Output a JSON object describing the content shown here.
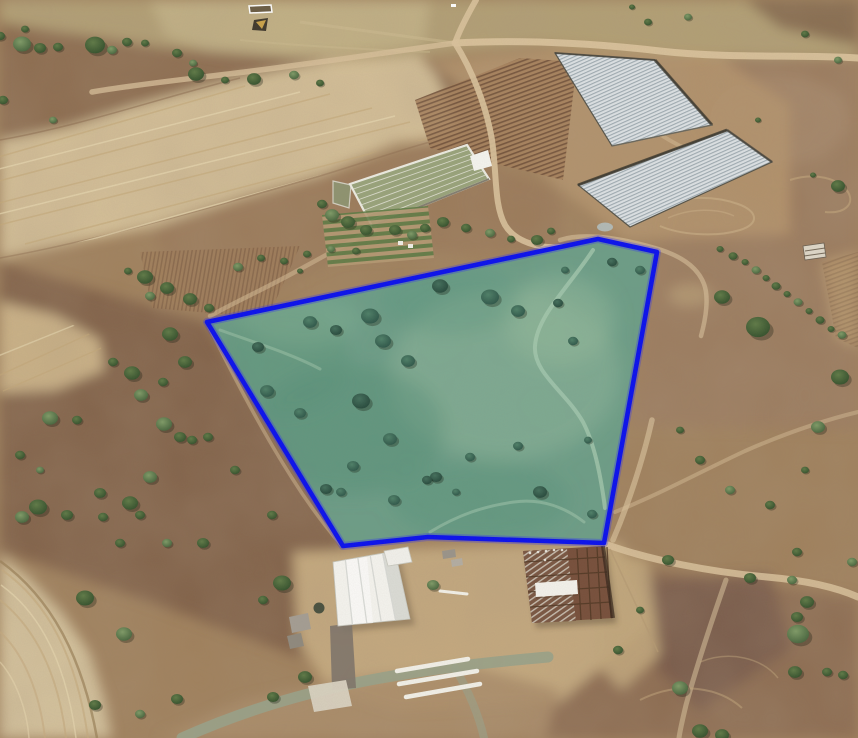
{
  "scene": {
    "kind": "aerial-satellite-imagery",
    "subject": "rural farmland with highlighted land parcel boundary"
  },
  "parcel": {
    "points": "207,322 598,239 657,252 604,543 428,537 343,546",
    "outline_color": "#0a10ee",
    "outline_width": 4.6,
    "glow_color": "#2a2aff",
    "fill_color": "#68a08b",
    "fill_opacity": 0.92
  },
  "palette": {
    "terrain_base": "#a0805c",
    "top_field": "#b3a074",
    "plowed_band": "#d7c29a",
    "scrub_dark": "#82624a",
    "right_brown": "#9c7c5f",
    "farm_yard": "#c6aa7f",
    "pale_field": "#d7c59f",
    "road": "#d9c29c",
    "gray_road": "#99a28a",
    "greenhouse_light": "#dde2e5",
    "greenhouse_stripe": "#9fabb2",
    "warehouse_white": "#f5f4ef",
    "steel_rust": "#774f3b",
    "tree_dark": "#304d2a",
    "tree_teal": "#2a5246",
    "parcel_track": "#a6cab0"
  },
  "features": {
    "greenhouses": {
      "upper_points": "555,53 655,60 712,125 612,146",
      "lower_points": "578,185 727,130 772,162 630,227",
      "nursery_points": "350,184 467,145 489,179 372,226",
      "nursery_cap_points": "470,156 488,150 492,166 474,171",
      "nursery_annex_points": "333,181 351,185 349,208 333,203",
      "garden_points": "322,215 428,206 434,258 328,267",
      "rows_field_points": "415,100 520,58 577,62 563,180 430,148",
      "rows_left_points": "140,252 300,246 268,318 152,308",
      "tr_rows_points": "822,262 858,252 858,348 836,338"
    },
    "farm": {
      "warehouse_points": "333,562 395,551 410,619 338,626",
      "warehouse_annex_points": "384,551 408,547 412,562 388,566",
      "steel_frame_points": "523,551 603,546 613,618 532,623",
      "steel_hatch_points": "523,551 567,549 576,621 532,623",
      "beam_points": "535,583 577,580 578,594 536,597",
      "driveway_points": "330,626 352,623 356,688 332,690",
      "pad_points": "308,686 346,680 352,706 314,712",
      "shed_ne_points": "803,246 824,243 826,257 805,260",
      "corral_points": "249,6 271,5 272,12 250,13",
      "mound_points": "254,20 268,18 266,31 252,30"
    },
    "pond": {
      "cx": 605,
      "cy": 227,
      "rx": 8,
      "ry": 4.5
    },
    "roads": [
      {
        "name": "top-east",
        "d": "M 455,43 C 530,39 600,44 660,51 C 730,59 800,54 858,58",
        "w": 7,
        "op": 0.95
      },
      {
        "name": "top-west",
        "d": "M 455,43 C 420,48 350,58 290,66 C 220,76 150,82 92,92",
        "w": 5.5,
        "op": 0.75
      },
      {
        "name": "top-stub",
        "d": "M 476,0 C 468,14 460,29 455,43",
        "w": 6,
        "op": 0.9
      },
      {
        "name": "down-to-parcel",
        "d": "M 455,43 C 472,70 486,105 492,140 C 497,175 494,205 505,225 C 515,242 540,249 562,247",
        "w": 6,
        "op": 0.9
      },
      {
        "name": "along-parcel-top",
        "d": "M 560,240 C 585,232 620,238 655,248 C 683,256 698,268 704,284 C 709,297 706,318 701,336",
        "w": 4.5,
        "op": 0.6
      },
      {
        "name": "parcel-right-low",
        "d": "M 652,420 C 643,460 628,505 613,540",
        "w": 5.5,
        "op": 0.65
      },
      {
        "name": "farm-east",
        "d": "M 608,545 C 650,560 710,572 767,577 C 812,581 840,589 858,597",
        "w": 7,
        "op": 0.85
      },
      {
        "name": "farm-branch-south",
        "d": "M 726,580 C 712,620 697,665 686,705 C 682,722 680,730 679,738",
        "w": 5,
        "op": 0.55
      },
      {
        "name": "northeast-track",
        "d": "M 615,512 C 660,494 700,472 745,451 C 786,433 825,420 858,412",
        "w": 4,
        "op": 0.45
      },
      {
        "name": "gray-road",
        "d": "M 182,738 C 240,712 300,694 360,682 C 420,670 480,663 548,657",
        "w": 11,
        "color": "#99a28a",
        "op": 0.9
      },
      {
        "name": "gray-branch",
        "d": "M 455,668 C 468,690 478,712 484,738",
        "w": 8,
        "color": "#99a28a",
        "op": 0.6
      },
      {
        "name": "nursery-west",
        "d": "M 375,228 C 348,243 320,258 295,272 C 268,287 235,302 210,316",
        "w": 4.5,
        "op": 0.5
      },
      {
        "name": "below-parcel-west",
        "d": "M 209,327 C 228,365 258,425 292,478 C 312,510 330,532 341,545",
        "w": 3.5,
        "op": 0.45
      },
      {
        "name": "between-greenhouses",
        "d": "M 640,120 C 665,140 690,152 718,162",
        "w": 4,
        "op": 0.45
      }
    ],
    "tracks_in_parcel": [
      {
        "d": "M 593,250 C 568,288 537,316 535,346 C 533,373 566,392 583,422 C 595,445 601,478 605,508",
        "w": 4,
        "op": 0.75
      },
      {
        "d": "M 430,532 C 458,515 484,506 514,502 C 542,498 566,508 584,522",
        "w": 3,
        "op": 0.5
      },
      {
        "d": "M 220,330 C 256,343 292,354 320,369",
        "w": 3,
        "op": 0.45
      }
    ],
    "pipes": [
      [
        397,
        671,
        468,
        659,
        4.5
      ],
      [
        399,
        684,
        477,
        671,
        4.5
      ],
      [
        406,
        697,
        480,
        684,
        4.5
      ],
      [
        440,
        591,
        467,
        594,
        3
      ]
    ],
    "trees_outside": [
      [
        22,
        44,
        9
      ],
      [
        40,
        48,
        6
      ],
      [
        58,
        47,
        5
      ],
      [
        95,
        45,
        10
      ],
      [
        112,
        50,
        5
      ],
      [
        127,
        42,
        5
      ],
      [
        145,
        43,
        4
      ],
      [
        177,
        53,
        5
      ],
      [
        193,
        63,
        4
      ],
      [
        25,
        29,
        4
      ],
      [
        0,
        36,
        5
      ],
      [
        3,
        100,
        5
      ],
      [
        53,
        120,
        4
      ],
      [
        196,
        74,
        8
      ],
      [
        225,
        80,
        4
      ],
      [
        254,
        79,
        7
      ],
      [
        294,
        75,
        5
      ],
      [
        320,
        83,
        4
      ],
      [
        128,
        271,
        4
      ],
      [
        145,
        277,
        8
      ],
      [
        150,
        296,
        5
      ],
      [
        167,
        288,
        7
      ],
      [
        190,
        299,
        7
      ],
      [
        209,
        308,
        5
      ],
      [
        238,
        267,
        5
      ],
      [
        261,
        258,
        4
      ],
      [
        284,
        261,
        4
      ],
      [
        307,
        254,
        4
      ],
      [
        331,
        249,
        4
      ],
      [
        356,
        251,
        4
      ],
      [
        300,
        271,
        3
      ],
      [
        322,
        204,
        5
      ],
      [
        332,
        215,
        7
      ],
      [
        348,
        222,
        7
      ],
      [
        366,
        230,
        6
      ],
      [
        395,
        230,
        6
      ],
      [
        412,
        235,
        5
      ],
      [
        425,
        228,
        5
      ],
      [
        443,
        222,
        6
      ],
      [
        466,
        228,
        5
      ],
      [
        490,
        233,
        5
      ],
      [
        511,
        239,
        4
      ],
      [
        537,
        240,
        6
      ],
      [
        551,
        231,
        4
      ],
      [
        50,
        418,
        8
      ],
      [
        77,
        420,
        5
      ],
      [
        113,
        362,
        5
      ],
      [
        132,
        373,
        8
      ],
      [
        141,
        395,
        7
      ],
      [
        163,
        382,
        5
      ],
      [
        170,
        334,
        8
      ],
      [
        185,
        362,
        7
      ],
      [
        164,
        424,
        8
      ],
      [
        180,
        437,
        6
      ],
      [
        192,
        440,
        5
      ],
      [
        208,
        437,
        5
      ],
      [
        150,
        477,
        7
      ],
      [
        100,
        493,
        6
      ],
      [
        130,
        503,
        8
      ],
      [
        38,
        507,
        9
      ],
      [
        22,
        517,
        7
      ],
      [
        67,
        515,
        6
      ],
      [
        103,
        517,
        5
      ],
      [
        140,
        515,
        5
      ],
      [
        167,
        543,
        5
      ],
      [
        203,
        543,
        6
      ],
      [
        120,
        543,
        5
      ],
      [
        20,
        455,
        5
      ],
      [
        40,
        470,
        4
      ],
      [
        235,
        470,
        5
      ],
      [
        272,
        515,
        5
      ],
      [
        85,
        598,
        9
      ],
      [
        124,
        634,
        8
      ],
      [
        263,
        600,
        5
      ],
      [
        282,
        583,
        9
      ],
      [
        95,
        705,
        6
      ],
      [
        140,
        714,
        5
      ],
      [
        177,
        699,
        6
      ],
      [
        273,
        697,
        6
      ],
      [
        305,
        677,
        7
      ],
      [
        433,
        585,
        6
      ],
      [
        618,
        650,
        5
      ],
      [
        640,
        610,
        4
      ],
      [
        668,
        560,
        6
      ],
      [
        680,
        688,
        8
      ],
      [
        700,
        731,
        8
      ],
      [
        722,
        735,
        7
      ],
      [
        750,
        578,
        6
      ],
      [
        792,
        580,
        5
      ],
      [
        795,
        672,
        7
      ],
      [
        797,
        552,
        5
      ],
      [
        797,
        617,
        6
      ],
      [
        798,
        634,
        11
      ],
      [
        807,
        602,
        7
      ],
      [
        827,
        672,
        5
      ],
      [
        843,
        675,
        5
      ],
      [
        852,
        562,
        5
      ],
      [
        680,
        430,
        4
      ],
      [
        700,
        460,
        5
      ],
      [
        722,
        297,
        8
      ],
      [
        730,
        490,
        5
      ],
      [
        758,
        327,
        12
      ],
      [
        770,
        505,
        5
      ],
      [
        805,
        470,
        4
      ],
      [
        818,
        427,
        7
      ],
      [
        840,
        377,
        9
      ],
      [
        632,
        7,
        3
      ],
      [
        648,
        22,
        4
      ],
      [
        688,
        17,
        4
      ],
      [
        758,
        120,
        3
      ],
      [
        805,
        34,
        4
      ],
      [
        813,
        175,
        3
      ],
      [
        838,
        60,
        4
      ],
      [
        838,
        186,
        7
      ]
    ],
    "trees_inside": [
      [
        440,
        286,
        8
      ],
      [
        490,
        297,
        9
      ],
      [
        518,
        311,
        7
      ],
      [
        558,
        303,
        5
      ],
      [
        370,
        316,
        9
      ],
      [
        310,
        322,
        7
      ],
      [
        336,
        330,
        6
      ],
      [
        383,
        341,
        8
      ],
      [
        408,
        361,
        7
      ],
      [
        258,
        347,
        6
      ],
      [
        267,
        391,
        7
      ],
      [
        300,
        413,
        6
      ],
      [
        361,
        401,
        9
      ],
      [
        390,
        439,
        7
      ],
      [
        353,
        466,
        6
      ],
      [
        326,
        489,
        6
      ],
      [
        341,
        492,
        5
      ],
      [
        394,
        500,
        6
      ],
      [
        436,
        477,
        6
      ],
      [
        470,
        457,
        5
      ],
      [
        518,
        446,
        5
      ],
      [
        540,
        492,
        7
      ],
      [
        573,
        341,
        5
      ],
      [
        592,
        514,
        5
      ],
      [
        427,
        480,
        5
      ],
      [
        456,
        492,
        4
      ],
      [
        588,
        440,
        4
      ],
      [
        612,
        262,
        5
      ],
      [
        640,
        270,
        5
      ],
      [
        565,
        270,
        4
      ]
    ],
    "hedge_bushes": [
      [
        720,
        249
      ],
      [
        733,
        256
      ],
      [
        745,
        262
      ],
      [
        756,
        270
      ],
      [
        766,
        278
      ],
      [
        776,
        286
      ],
      [
        787,
        294
      ],
      [
        798,
        302
      ],
      [
        809,
        311
      ],
      [
        820,
        320
      ],
      [
        831,
        329
      ],
      [
        842,
        335
      ]
    ]
  }
}
